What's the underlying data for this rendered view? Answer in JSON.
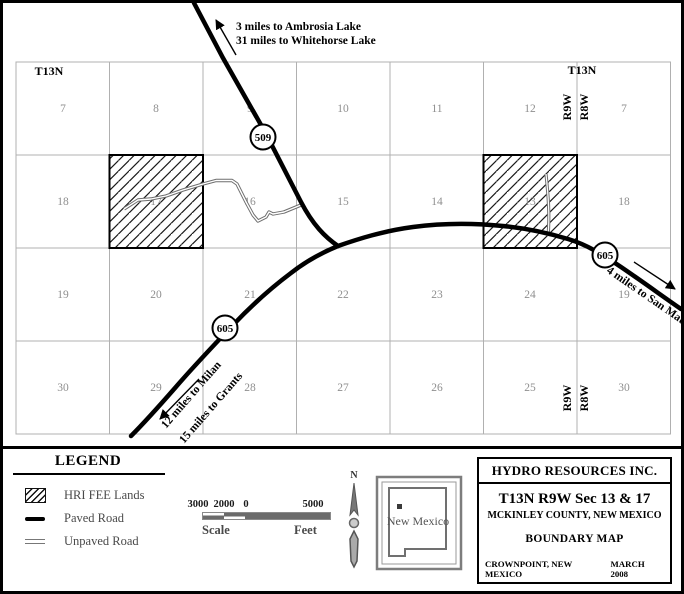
{
  "map": {
    "township_label_left": "T13N",
    "township_label_right": "T13N",
    "range_label_west": "R9W",
    "range_label_east": "R8W",
    "section_rows": [
      [
        "7",
        "8",
        "9",
        "10",
        "11",
        "12",
        "7"
      ],
      [
        "18",
        "17",
        "16",
        "15",
        "14",
        "13",
        "18"
      ],
      [
        "19",
        "20",
        "21",
        "22",
        "23",
        "24",
        "19"
      ],
      [
        "30",
        "29",
        "28",
        "27",
        "26",
        "25",
        "30"
      ]
    ],
    "route_shields": {
      "nw": "509",
      "sw": "605",
      "se": "605"
    },
    "annotations": {
      "north_line1": "3 miles to Ambrosia Lake",
      "north_line2": "31 miles to Whitehorse Lake",
      "southwest_line1": "12 miles to Milan",
      "southwest_line2": "15 miles to Grants",
      "east_line": "4 miles to San Mateo"
    }
  },
  "legend": {
    "title": "LEGEND",
    "items": [
      {
        "symbol": "hatch-swatch",
        "label": "HRI FEE Lands"
      },
      {
        "symbol": "paved-line",
        "label": "Paved Road"
      },
      {
        "symbol": "unpaved-line",
        "label": "Unpaved Road"
      }
    ]
  },
  "scale_bar": {
    "tick_labels": [
      "3000",
      "2000",
      "0",
      "5000"
    ],
    "left_label": "Scale",
    "right_label": "Feet"
  },
  "compass": {
    "north_label": "N"
  },
  "inset": {
    "state_name": "New Mexico"
  },
  "title_block": {
    "company": "HYDRO RESOURCES INC.",
    "location": "T13N R9W Sec 13 & 17",
    "county": "MCKINLEY COUNTY, NEW MEXICO",
    "map_type": "BOUNDARY MAP",
    "city": "CROWNPOINT, NEW MEXICO",
    "date": "MARCH 2008"
  },
  "colors": {
    "paved_road": "#000000",
    "unpaved_road": "#6e6e6e",
    "grid_line": "#b0b0b0",
    "section_number": "#8f8f8f",
    "hatch": "#1a1a1a"
  }
}
